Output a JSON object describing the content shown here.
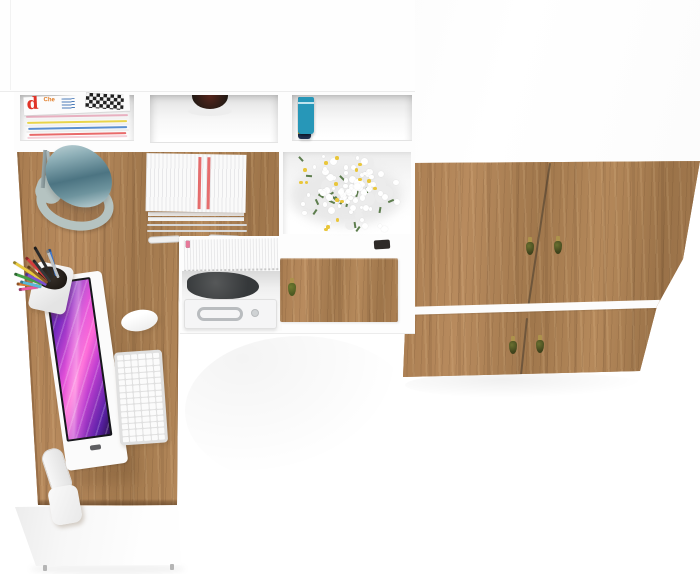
{
  "scene": {
    "alt": "Top-down photo of a white and craft-oak office set: hutch shelving with magazines, books, flowers and printer, L-shaped oak desk with monitor, keyboard, mouse, lamp and pencil cup, and a wardrobe with tassel handles",
    "colors": {
      "floor": "#ffffff",
      "furniture_white": "#fdfdfd",
      "wood_base": "#ab7f53",
      "wood_light": "#c59a6b",
      "wood_dark": "#7c5836",
      "lamp_teal_dark": "#4c7482",
      "lamp_base_gray": "#b5c3c1",
      "screen_purple": "#7b2cc0",
      "screen_magenta": "#e24fd8",
      "screen_pink": "#ff6ad8",
      "screen_deep": "#2d0f52",
      "tassel_gold": "#ad924c",
      "tassel_green_dark": "#3f431c",
      "red_stripe": "#e25555",
      "printer_body": "#f5f5f6",
      "printer_handle": "#b9bcbf"
    }
  },
  "magazines": {
    "big_letter": "d",
    "big_letter_color": "#e03428",
    "small_text": "Che",
    "small_text_color": "#e07820",
    "stripes": [
      {
        "x": 2,
        "y": 20,
        "w": 102,
        "c": "#e8b0c0"
      },
      {
        "x": 0,
        "y": 23,
        "w": 105,
        "c": "#f3f3f3"
      },
      {
        "x": 3,
        "y": 26,
        "w": 100,
        "c": "#e8d44a"
      },
      {
        "x": 1,
        "y": 29,
        "w": 104,
        "c": "#f0f0f0"
      },
      {
        "x": 4,
        "y": 32,
        "w": 99,
        "c": "#5a8fd0"
      },
      {
        "x": 2,
        "y": 35,
        "w": 103,
        "c": "#ededed"
      },
      {
        "x": 5,
        "y": 38,
        "w": 97,
        "c": "#e86a6a"
      },
      {
        "x": 3,
        "y": 41,
        "w": 100,
        "c": "#f5d0d8"
      }
    ]
  },
  "books": [
    {
      "c": "#8e3038",
      "w": 12,
      "h": 31,
      "dy": 2,
      "band": ""
    },
    {
      "c": "#20304f",
      "w": 13,
      "h": 42,
      "dy": 0,
      "band": "#c9a22a",
      "band2": true
    },
    {
      "c": "#2f5cae",
      "w": 12,
      "h": 33,
      "dy": 1,
      "band": "#9db8e0"
    },
    {
      "c": "#1b1b20",
      "w": 13,
      "h": 35,
      "dy": 0,
      "band": "#e8e8e8"
    },
    {
      "c": "#2d6130",
      "w": 12,
      "h": 35,
      "dy": 2,
      "band": "#c9a22a"
    },
    {
      "c": "#602a20",
      "w": 11,
      "h": 35,
      "dy": 1,
      "band": "#c9a22a",
      "band2": true
    },
    {
      "c": "#cfc3a4",
      "w": 11,
      "h": 33,
      "dy": 3,
      "band": ""
    },
    {
      "c": "#2797b8",
      "w": 16,
      "h": 37,
      "dy": 0,
      "band": "#bfe4ee"
    }
  ],
  "flowers": {
    "seed": 7,
    "grays": 18,
    "leaves": 20,
    "petals": 85,
    "centers": 16,
    "petal_color": "#ffffff",
    "gray_color": "#ececec",
    "center_color": "#e9c63b",
    "leaf_color": "#5d7d4d"
  },
  "tabs": {
    "colors": [
      "#e85898",
      "#f0d040",
      "#58b8e8",
      "#9058d8",
      "#e87040",
      "#58c878",
      "#e85858",
      "#4878d8",
      "#f0a040",
      "#d058c8",
      "#40c8c0",
      "#f0e058",
      "#7890e8",
      "#e87898"
    ]
  },
  "pens": [
    {
      "c": "#2b2b2b",
      "len": 36,
      "ang": -30,
      "bx": 40,
      "by": 46
    },
    {
      "c": "#d43c3c",
      "len": 32,
      "ang": -45,
      "bx": 36,
      "by": 48
    },
    {
      "c": "#e8c93e",
      "len": 38,
      "ang": -58,
      "bx": 33,
      "by": 50
    },
    {
      "c": "#3e7bd4",
      "len": 28,
      "ang": -15,
      "bx": 44,
      "by": 44
    },
    {
      "c": "#44a048",
      "len": 30,
      "ang": -70,
      "bx": 30,
      "by": 52
    },
    {
      "c": "#e07f36",
      "len": 24,
      "ang": -85,
      "bx": 28,
      "by": 54
    },
    {
      "c": "#bfc3c6",
      "len": 30,
      "ang": -22,
      "bx": 46,
      "by": 46
    },
    {
      "c": "#7a4fd0",
      "len": 24,
      "ang": -62,
      "bx": 34,
      "by": 53
    },
    {
      "c": "#e858a0",
      "len": 20,
      "ang": -98,
      "bx": 26,
      "by": 55
    },
    {
      "c": "#35383a",
      "len": 28,
      "ang": -38,
      "bx": 38,
      "by": 50
    },
    {
      "c": "#58b8d8",
      "len": 22,
      "ang": -76,
      "bx": 29,
      "by": 55
    },
    {
      "c": "#8a5a2a",
      "len": 26,
      "ang": -50,
      "bx": 35,
      "by": 51
    }
  ],
  "keyboard": {
    "rows": 14,
    "cols": 6
  },
  "tray": {
    "stripe_color": "#e25555"
  },
  "drawer_handle": {
    "cap": "#ad924c",
    "body": "#4c5a22"
  }
}
